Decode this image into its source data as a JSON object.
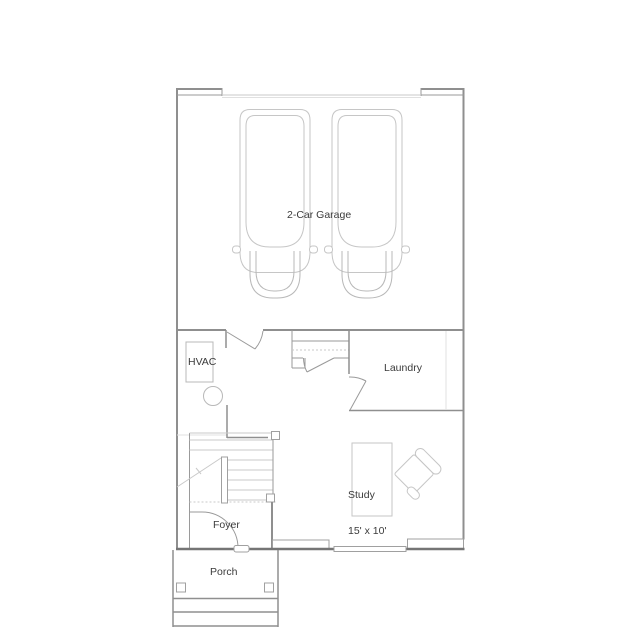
{
  "colors": {
    "background": "#ffffff",
    "wall": "#8f8f8f",
    "wall_dark": "#757575",
    "wall_thin": "#9a9a9a",
    "light_line": "#c9c9c9",
    "furniture": "#c6c6c6",
    "text": "#3b3b3b"
  },
  "rooms": {
    "garage": {
      "label": "2-Car Garage"
    },
    "hvac": {
      "label": "HVAC"
    },
    "laundry": {
      "label": "Laundry"
    },
    "study": {
      "label": "Study",
      "size": "15' x 10'"
    },
    "foyer": {
      "label": "Foyer"
    },
    "porch": {
      "label": "Porch"
    }
  }
}
